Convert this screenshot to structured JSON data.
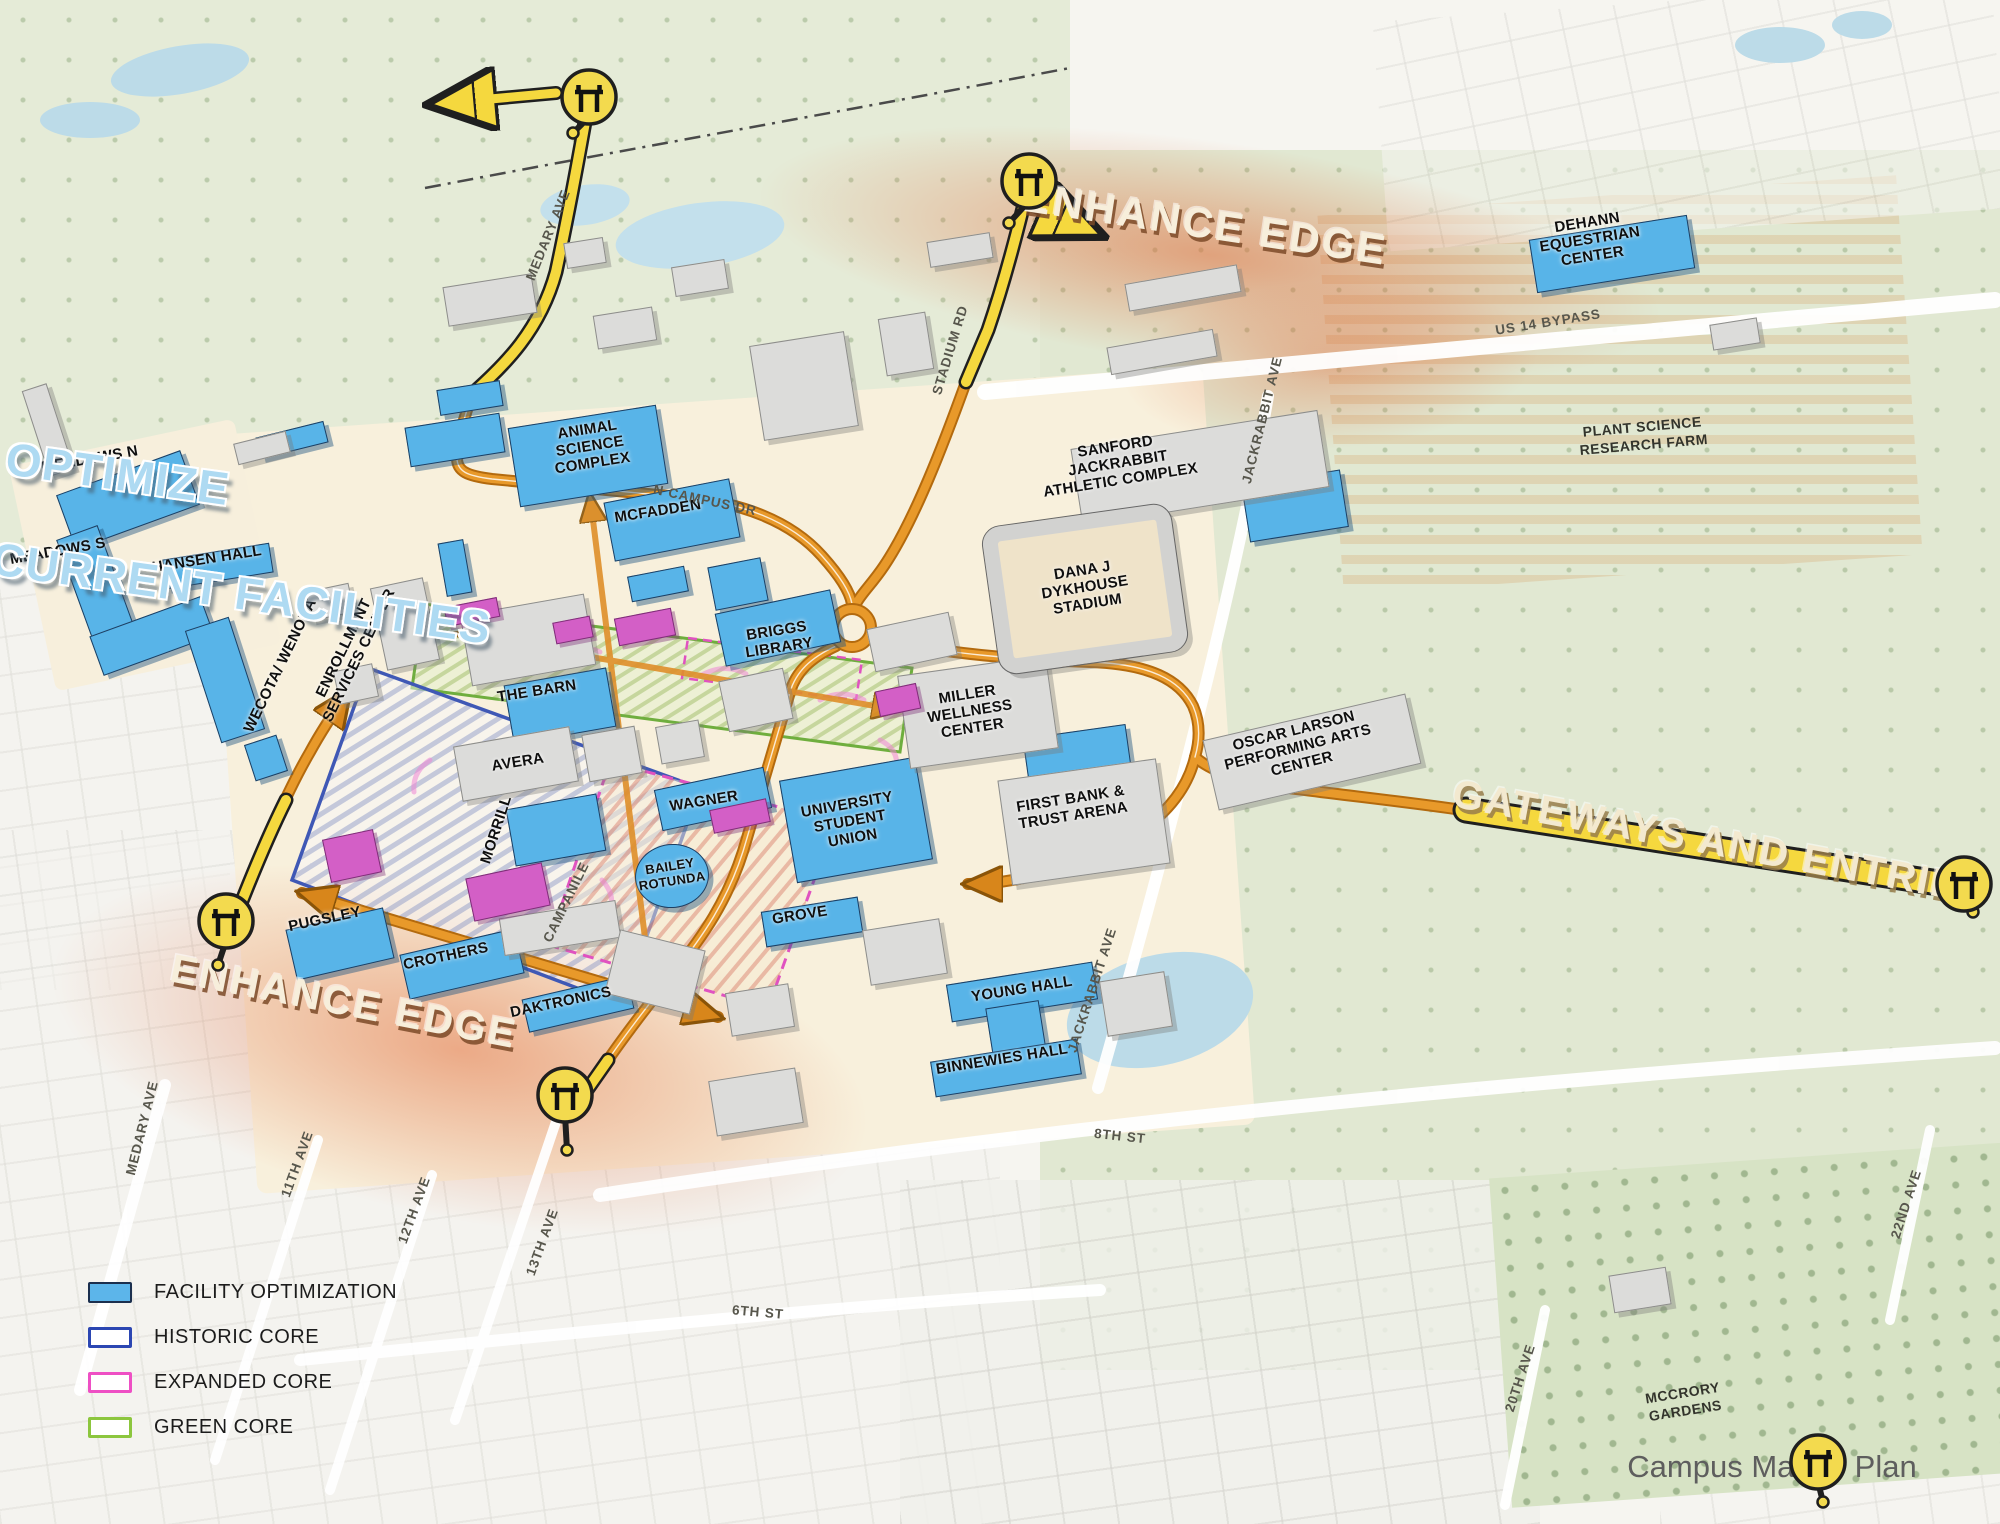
{
  "annotations": {
    "optimize_line1": "OPTIMIZE",
    "optimize_line2": "CURRENT FACILITIES",
    "enhance_edge_top": "ENHANCE EDGE",
    "enhance_edge_bottom": "ENHANCE EDGE",
    "gateways": "GATEWAYS AND ENTRIES",
    "caption": "Campus Master Plan"
  },
  "legend": {
    "items": [
      {
        "label": "FACILITY OPTIMIZATION",
        "swatch": "fill-blue"
      },
      {
        "label": "HISTORIC CORE",
        "swatch": "outline-blue"
      },
      {
        "label": "EXPANDED CORE",
        "swatch": "outline-magenta"
      },
      {
        "label": "GREEN CORE",
        "swatch": "outline-green"
      }
    ]
  },
  "colors": {
    "facility_optimization": "#58b4e8",
    "historic_core": "#2b46b2",
    "expanded_core": "#ee4fc4",
    "green_core": "#8cc63e",
    "route_orange": "#d8861b",
    "route_yellow": "#f5d83e"
  },
  "map": {
    "buildings": [
      {
        "x": 128,
        "y": 500,
        "w": 132,
        "h": 58,
        "r": -20,
        "c": "b"
      },
      {
        "x": 97,
        "y": 588,
        "w": 44,
        "h": 118,
        "r": -20,
        "c": "b"
      },
      {
        "x": 152,
        "y": 636,
        "w": 118,
        "h": 42,
        "r": -20,
        "c": "b"
      },
      {
        "x": 218,
        "y": 566,
        "w": 108,
        "h": 30,
        "r": -9,
        "c": "b"
      },
      {
        "x": 292,
        "y": 440,
        "w": 70,
        "h": 22,
        "r": -14,
        "c": "b"
      },
      {
        "x": 225,
        "y": 680,
        "w": 46,
        "h": 118,
        "r": -18,
        "c": "b"
      },
      {
        "x": 266,
        "y": 758,
        "w": 34,
        "h": 38,
        "r": -18,
        "c": "b"
      },
      {
        "x": 455,
        "y": 568,
        "w": 26,
        "h": 54,
        "r": -10,
        "c": "b"
      },
      {
        "x": 470,
        "y": 398,
        "w": 64,
        "h": 26,
        "r": -9,
        "c": "b"
      },
      {
        "x": 455,
        "y": 440,
        "w": 96,
        "h": 40,
        "r": -9,
        "c": "b"
      },
      {
        "x": 588,
        "y": 456,
        "w": 150,
        "h": 80,
        "r": -9,
        "c": "b"
      },
      {
        "x": 672,
        "y": 520,
        "w": 128,
        "h": 60,
        "r": -11,
        "c": "b"
      },
      {
        "x": 658,
        "y": 584,
        "w": 58,
        "h": 26,
        "r": -11,
        "c": "b"
      },
      {
        "x": 738,
        "y": 584,
        "w": 54,
        "h": 44,
        "r": -11,
        "c": "b"
      },
      {
        "x": 778,
        "y": 628,
        "w": 118,
        "h": 54,
        "r": -12,
        "c": "b"
      },
      {
        "x": 560,
        "y": 706,
        "w": 104,
        "h": 60,
        "r": -10,
        "c": "b"
      },
      {
        "x": 556,
        "y": 830,
        "w": 92,
        "h": 58,
        "r": -10,
        "c": "b"
      },
      {
        "x": 713,
        "y": 799,
        "w": 112,
        "h": 42,
        "r": -12,
        "c": "b"
      },
      {
        "x": 672,
        "y": 876,
        "w": 74,
        "h": 64,
        "r": -6,
        "c": "b",
        "round": 1
      },
      {
        "x": 856,
        "y": 820,
        "w": 138,
        "h": 104,
        "r": -10,
        "c": "b"
      },
      {
        "x": 812,
        "y": 922,
        "w": 98,
        "h": 36,
        "r": -9,
        "c": "b"
      },
      {
        "x": 1022,
        "y": 992,
        "w": 148,
        "h": 38,
        "r": -9,
        "c": "b"
      },
      {
        "x": 1016,
        "y": 1030,
        "w": 54,
        "h": 52,
        "r": -9,
        "c": "b"
      },
      {
        "x": 1006,
        "y": 1068,
        "w": 148,
        "h": 36,
        "r": -9,
        "c": "b"
      },
      {
        "x": 340,
        "y": 944,
        "w": 100,
        "h": 52,
        "r": -13,
        "c": "b"
      },
      {
        "x": 462,
        "y": 964,
        "w": 118,
        "h": 46,
        "r": -13,
        "c": "b"
      },
      {
        "x": 578,
        "y": 1004,
        "w": 108,
        "h": 34,
        "r": -13,
        "c": "b"
      },
      {
        "x": 1612,
        "y": 254,
        "w": 160,
        "h": 54,
        "r": -9,
        "c": "b"
      },
      {
        "x": 1295,
        "y": 506,
        "w": 100,
        "h": 58,
        "r": -9,
        "c": "b"
      },
      {
        "x": 1078,
        "y": 760,
        "w": 104,
        "h": 58,
        "r": -8,
        "c": "b"
      },
      {
        "x": 490,
        "y": 300,
        "w": 90,
        "h": 40,
        "r": -9,
        "c": "g"
      },
      {
        "x": 625,
        "y": 328,
        "w": 60,
        "h": 34,
        "r": -9,
        "c": "g"
      },
      {
        "x": 700,
        "y": 278,
        "w": 54,
        "h": 30,
        "r": -9,
        "c": "g"
      },
      {
        "x": 585,
        "y": 253,
        "w": 40,
        "h": 26,
        "r": -9,
        "c": "g"
      },
      {
        "x": 804,
        "y": 386,
        "w": 96,
        "h": 96,
        "r": -9,
        "c": "g"
      },
      {
        "x": 906,
        "y": 344,
        "w": 48,
        "h": 58,
        "r": -9,
        "c": "g"
      },
      {
        "x": 960,
        "y": 250,
        "w": 64,
        "h": 26,
        "r": -9,
        "c": "g"
      },
      {
        "x": 528,
        "y": 640,
        "w": 126,
        "h": 72,
        "r": -10,
        "c": "g"
      },
      {
        "x": 405,
        "y": 624,
        "w": 54,
        "h": 84,
        "r": -12,
        "c": "g"
      },
      {
        "x": 330,
        "y": 602,
        "w": 44,
        "h": 30,
        "r": -12,
        "c": "g"
      },
      {
        "x": 356,
        "y": 684,
        "w": 40,
        "h": 34,
        "r": -12,
        "c": "g"
      },
      {
        "x": 516,
        "y": 764,
        "w": 118,
        "h": 56,
        "r": -10,
        "c": "g"
      },
      {
        "x": 612,
        "y": 754,
        "w": 54,
        "h": 48,
        "r": -10,
        "c": "g"
      },
      {
        "x": 680,
        "y": 742,
        "w": 44,
        "h": 38,
        "r": -10,
        "c": "g"
      },
      {
        "x": 756,
        "y": 700,
        "w": 66,
        "h": 52,
        "r": -12,
        "c": "g"
      },
      {
        "x": 912,
        "y": 642,
        "w": 84,
        "h": 44,
        "r": -12,
        "c": "g"
      },
      {
        "x": 978,
        "y": 712,
        "w": 150,
        "h": 94,
        "r": -8,
        "c": "g"
      },
      {
        "x": 1084,
        "y": 822,
        "w": 160,
        "h": 106,
        "r": -8,
        "c": "g"
      },
      {
        "x": 1200,
        "y": 468,
        "w": 250,
        "h": 78,
        "r": -9,
        "c": "g"
      },
      {
        "x": 1312,
        "y": 752,
        "w": 208,
        "h": 72,
        "r": -13,
        "c": "g"
      },
      {
        "x": 48,
        "y": 430,
        "w": 26,
        "h": 90,
        "r": -18,
        "c": "g"
      },
      {
        "x": 262,
        "y": 448,
        "w": 54,
        "h": 22,
        "r": -14,
        "c": "g"
      },
      {
        "x": 560,
        "y": 928,
        "w": 118,
        "h": 38,
        "r": -9,
        "c": "g"
      },
      {
        "x": 655,
        "y": 972,
        "w": 88,
        "h": 66,
        "r": 14,
        "c": "g"
      },
      {
        "x": 760,
        "y": 1010,
        "w": 64,
        "h": 44,
        "r": -9,
        "c": "g"
      },
      {
        "x": 905,
        "y": 952,
        "w": 78,
        "h": 56,
        "r": -9,
        "c": "g"
      },
      {
        "x": 756,
        "y": 1102,
        "w": 88,
        "h": 56,
        "r": -9,
        "c": "g"
      },
      {
        "x": 1136,
        "y": 1004,
        "w": 66,
        "h": 56,
        "r": -9,
        "c": "g"
      },
      {
        "x": 1183,
        "y": 288,
        "w": 114,
        "h": 28,
        "r": -10,
        "c": "g"
      },
      {
        "x": 1162,
        "y": 352,
        "w": 108,
        "h": 28,
        "r": -10,
        "c": "g"
      },
      {
        "x": 1735,
        "y": 334,
        "w": 48,
        "h": 26,
        "r": -9,
        "c": "g"
      },
      {
        "x": 1640,
        "y": 1290,
        "w": 58,
        "h": 38,
        "r": -9,
        "c": "g"
      },
      {
        "x": 472,
        "y": 612,
        "w": 54,
        "h": 20,
        "r": -11,
        "c": "m"
      },
      {
        "x": 573,
        "y": 630,
        "w": 38,
        "h": 22,
        "r": -11,
        "c": "m"
      },
      {
        "x": 645,
        "y": 627,
        "w": 58,
        "h": 28,
        "r": -11,
        "c": "m"
      },
      {
        "x": 740,
        "y": 816,
        "w": 58,
        "h": 24,
        "r": -12,
        "c": "m"
      },
      {
        "x": 352,
        "y": 856,
        "w": 52,
        "h": 44,
        "r": -12,
        "c": "m"
      },
      {
        "x": 508,
        "y": 892,
        "w": 78,
        "h": 44,
        "r": -12,
        "c": "m"
      },
      {
        "x": 898,
        "y": 700,
        "w": 42,
        "h": 26,
        "r": -12,
        "c": "m"
      }
    ],
    "building_labels": [
      {
        "t": "MEADOWS N",
        "x": 90,
        "y": 460,
        "r": -10
      },
      {
        "t": "MEADOWS S",
        "x": 58,
        "y": 552,
        "r": -10
      },
      {
        "t": "HANSEN HALL",
        "x": 207,
        "y": 560,
        "r": -9
      },
      {
        "t": "WECOTA/ WENONA",
        "x": 281,
        "y": 666,
        "r": -64
      },
      {
        "t": "ENROLLMENT\nSERVICES CENTER",
        "x": 352,
        "y": 652,
        "r": -64
      },
      {
        "t": "ANIMAL\nSCIENCE\nCOMPLEX",
        "x": 590,
        "y": 447,
        "r": -9
      },
      {
        "t": "MCFADDEN",
        "x": 658,
        "y": 512,
        "r": -9
      },
      {
        "t": "BRIGGS\nLIBRARY",
        "x": 778,
        "y": 640,
        "r": -9
      },
      {
        "t": "THE BARN",
        "x": 537,
        "y": 692,
        "r": -9
      },
      {
        "t": "AVERA",
        "x": 518,
        "y": 763,
        "r": -9
      },
      {
        "t": "MORRILL",
        "x": 497,
        "y": 830,
        "r": -72
      },
      {
        "t": "WAGNER",
        "x": 704,
        "y": 802,
        "r": -9
      },
      {
        "t": "BAILEY\nROTUNDA",
        "x": 671,
        "y": 874,
        "r": -9,
        "s": 13
      },
      {
        "t": "UNIVERSITY\nSTUDENT\nUNION",
        "x": 850,
        "y": 822,
        "r": -10
      },
      {
        "t": "GROVE",
        "x": 800,
        "y": 916,
        "r": -9
      },
      {
        "t": "MILLER\nWELLNESS\nCENTER",
        "x": 970,
        "y": 712,
        "r": -9
      },
      {
        "t": "FIRST BANK &\nTRUST ARENA",
        "x": 1072,
        "y": 808,
        "r": -9
      },
      {
        "t": "DANA J\nDYKHOUSE\nSTADIUM",
        "x": 1085,
        "y": 588,
        "r": -9
      },
      {
        "t": "SANFORD\nJACKRABBIT\nATHLETIC COMPLEX",
        "x": 1118,
        "y": 464,
        "r": -9
      },
      {
        "t": "OSCAR LARSON\nPERFORMING ARTS\nCENTER",
        "x": 1298,
        "y": 748,
        "r": -14
      },
      {
        "t": "DEHANN\nEQUESTRIAN\nCENTER",
        "x": 1590,
        "y": 240,
        "r": -9
      },
      {
        "t": "YOUNG HALL",
        "x": 1022,
        "y": 990,
        "r": -9
      },
      {
        "t": "BINNEWIES HALL",
        "x": 1002,
        "y": 1060,
        "r": -9
      },
      {
        "t": "PUGSLEY",
        "x": 325,
        "y": 920,
        "r": -12
      },
      {
        "t": "CROTHERS",
        "x": 446,
        "y": 957,
        "r": -12
      },
      {
        "t": "DAKTRONICS",
        "x": 561,
        "y": 1003,
        "r": -12
      }
    ],
    "region_labels": [
      {
        "t": "PLANT SCIENCE\nRESEARCH FARM",
        "x": 1643,
        "y": 436,
        "r": -5
      },
      {
        "t": "MCCRORY\nGARDENS",
        "x": 1684,
        "y": 1402,
        "r": -9
      }
    ],
    "street_labels": [
      {
        "t": "MEDARY AVE",
        "x": 548,
        "y": 235,
        "r": -68
      },
      {
        "t": "N CAMPUS DR",
        "x": 705,
        "y": 500,
        "r": 12
      },
      {
        "t": "STADIUM RD",
        "x": 950,
        "y": 350,
        "r": -73
      },
      {
        "t": "JACKRABBIT AVE",
        "x": 1262,
        "y": 420,
        "r": -76
      },
      {
        "t": "US 14 BYPASS",
        "x": 1548,
        "y": 322,
        "r": -9
      },
      {
        "t": "JACKRABBIT AVE",
        "x": 1092,
        "y": 990,
        "r": -72
      },
      {
        "t": "8TH ST",
        "x": 1120,
        "y": 1136,
        "r": 6
      },
      {
        "t": "6TH ST",
        "x": 758,
        "y": 1312,
        "r": 5
      },
      {
        "t": "MEDARY AVE",
        "x": 142,
        "y": 1128,
        "r": -76
      },
      {
        "t": "11TH AVE",
        "x": 297,
        "y": 1164,
        "r": -70
      },
      {
        "t": "12TH AVE",
        "x": 414,
        "y": 1210,
        "r": -70
      },
      {
        "t": "13TH AVE",
        "x": 542,
        "y": 1242,
        "r": -70
      },
      {
        "t": "20TH AVE",
        "x": 1520,
        "y": 1378,
        "r": -72
      },
      {
        "t": "22ND AVE",
        "x": 1906,
        "y": 1204,
        "r": -72
      },
      {
        "t": "CAMPANILE",
        "x": 566,
        "y": 902,
        "r": -64
      }
    ],
    "gates": [
      {
        "x": 589,
        "y": 97,
        "sx": -16,
        "sy": 36
      },
      {
        "x": 1029,
        "y": 181,
        "sx": -20,
        "sy": 42
      },
      {
        "x": 226,
        "y": 921,
        "sx": -8,
        "sy": 44
      },
      {
        "x": 565,
        "y": 1095,
        "sx": 2,
        "sy": 55
      },
      {
        "x": 1964,
        "y": 884,
        "sx": 9,
        "sy": 28
      },
      {
        "x": 1818,
        "y": 1462,
        "sx": 5,
        "sy": 40
      }
    ]
  }
}
